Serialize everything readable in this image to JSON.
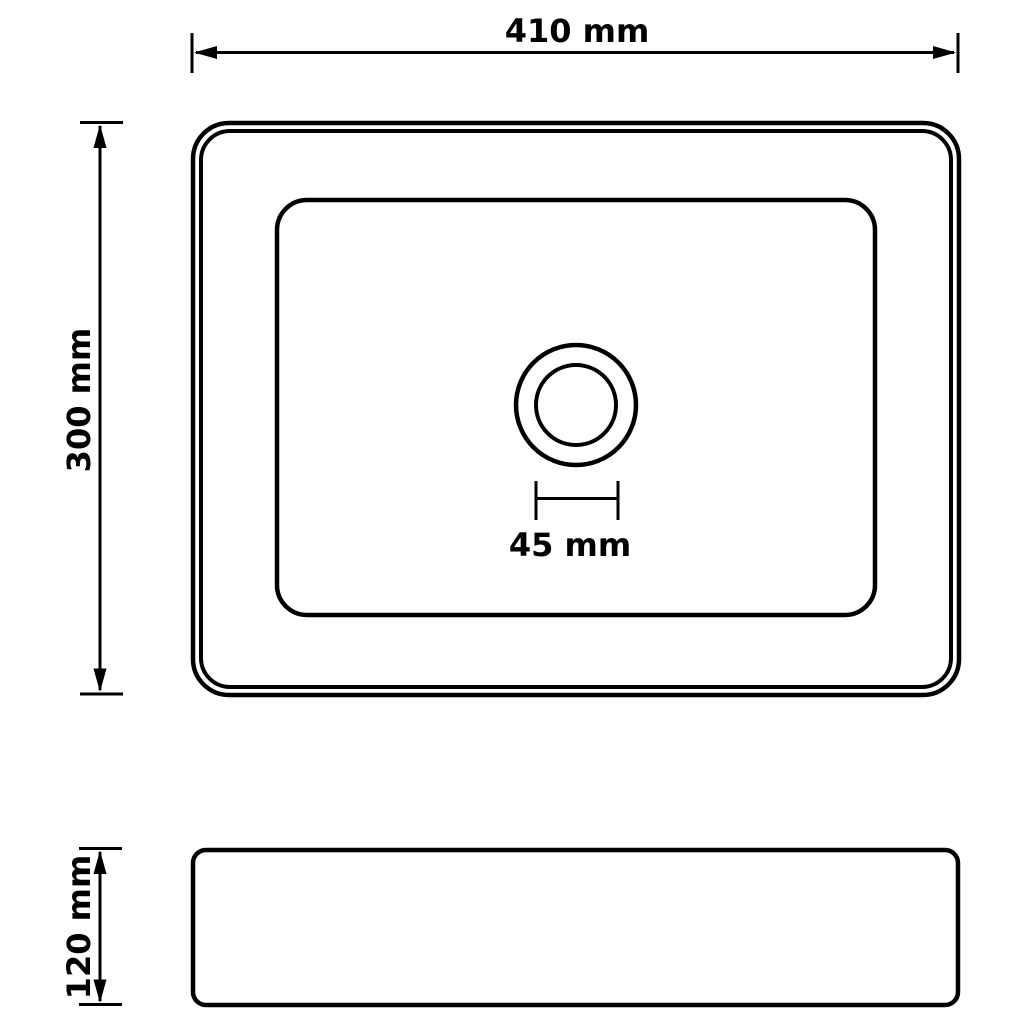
{
  "colors": {
    "line": "#000000",
    "background": "#ffffff"
  },
  "top_view": {
    "width_dimension": {
      "label": "410 mm"
    },
    "height_dimension": {
      "label": "300 mm"
    },
    "drain_dimension": {
      "label": "45 mm"
    }
  },
  "side_view": {
    "height_dimension": {
      "label": "120 mm"
    }
  }
}
